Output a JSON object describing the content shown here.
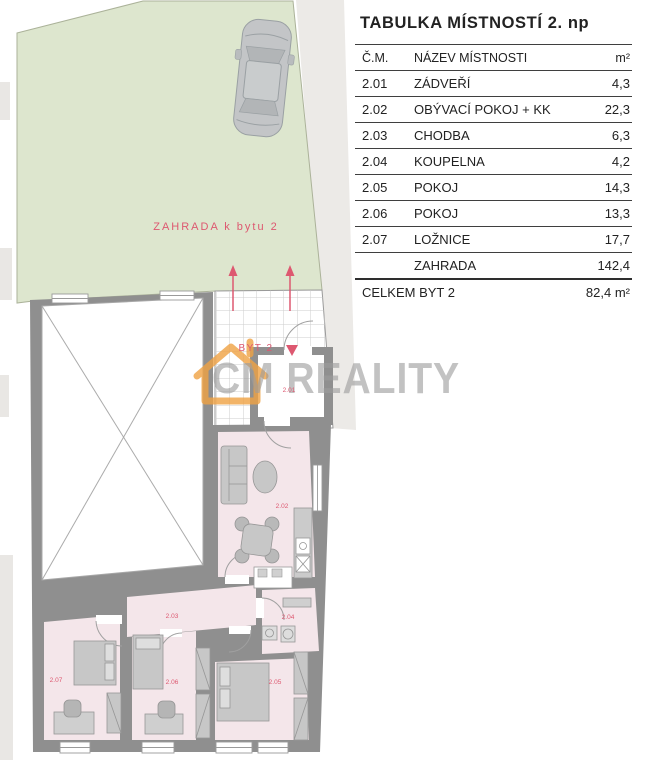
{
  "table": {
    "title": "TABULKA MÍSTNOSTÍ 2. np",
    "columns": {
      "num": "Č.M.",
      "name": "NÁZEV MÍSTNOSTI",
      "area": "m²"
    },
    "rows": [
      {
        "num": "2.01",
        "name": "ZÁDVEŘÍ",
        "area": "4,3"
      },
      {
        "num": "2.02",
        "name": "OBÝVACÍ POKOJ + KK",
        "area": "22,3"
      },
      {
        "num": "2.03",
        "name": "CHODBA",
        "area": "6,3"
      },
      {
        "num": "2.04",
        "name": "KOUPELNA",
        "area": "4,2"
      },
      {
        "num": "2.05",
        "name": "POKOJ",
        "area": "14,3"
      },
      {
        "num": "2.06",
        "name": "POKOJ",
        "area": "13,3"
      },
      {
        "num": "2.07",
        "name": "LOŽNICE",
        "area": "17,7"
      },
      {
        "num": "",
        "name": "ZAHRADA",
        "area": "142,4"
      }
    ],
    "total": {
      "label": "CELKEM BYT 2",
      "area": "82,4 m²"
    }
  },
  "plan": {
    "garden_label": "ZAHRADA k bytu 2",
    "entrance_label": "BYT 2",
    "watermark": "CM REALITY",
    "room_labels": {
      "r201": "2.01",
      "r202": "2.02",
      "r203": "2.03",
      "r204": "2.04",
      "r205": "2.05",
      "r206": "2.06",
      "r207": "2.07"
    },
    "colors": {
      "garden": "#dde6ce",
      "room_fill": "#f4e6ea",
      "wall": "#8f8f8f",
      "accent_red": "#dd5870",
      "watermark_orange": "#f0a243",
      "watermark_gray": "#9c9c9c"
    }
  }
}
